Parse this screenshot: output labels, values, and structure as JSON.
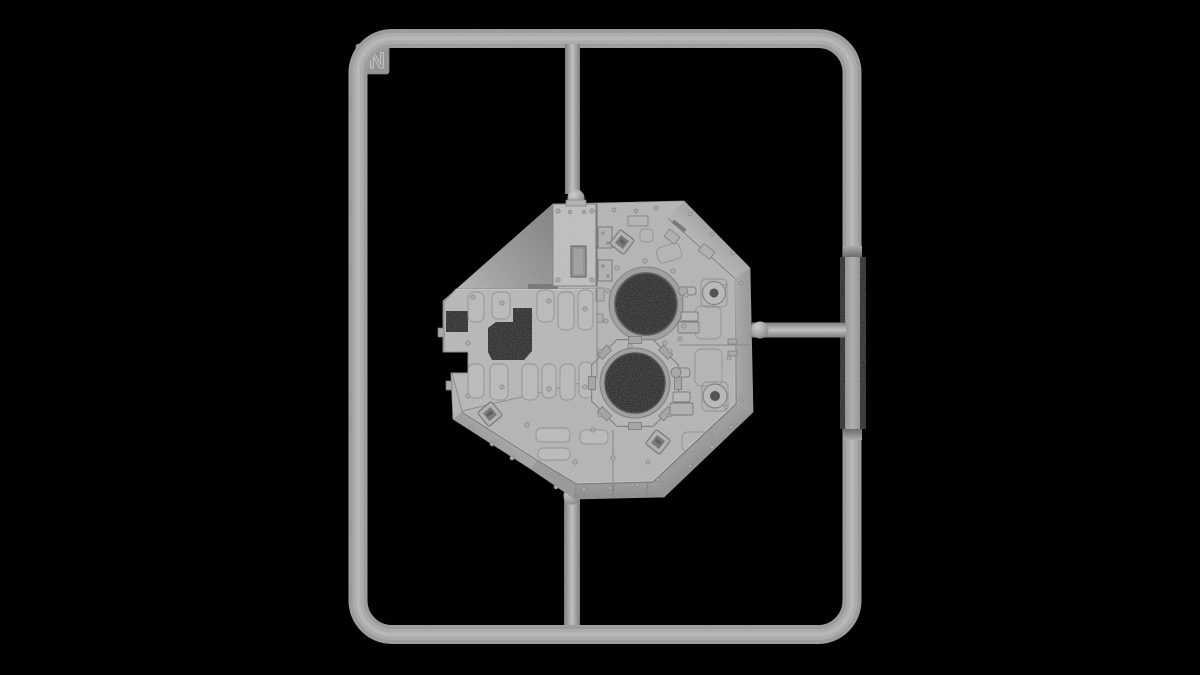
{
  "scene": {
    "background_color": "#000000",
    "description": "3D render of an injection-molded model kit sprue on black",
    "sprue": {
      "label": "N",
      "frame_color": "#a8a8a8",
      "runner_color": "#a2a2a2",
      "runners": [
        "top",
        "bottom",
        "right"
      ],
      "part": {
        "name": "turret roof panel",
        "color": "#b3b3b3",
        "hatch_openings": 2,
        "features": [
          "upper-hatch-opening",
          "lower-hatch-opening-octagonal-surround",
          "stowage-box",
          "periscope-housings",
          "anti-slip-pads",
          "lifting-eye-discs",
          "panel-cutout"
        ]
      }
    }
  }
}
